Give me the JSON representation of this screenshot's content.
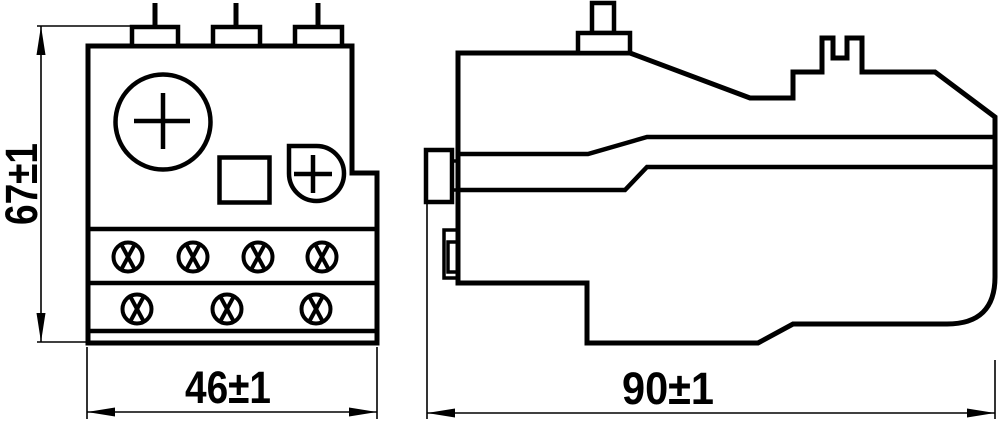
{
  "drawing": {
    "background": "#ffffff",
    "line_color": "#000000",
    "dimensions": {
      "height_label": "67±1",
      "front_width_label": "46±1",
      "side_width_label": "90±1"
    }
  }
}
